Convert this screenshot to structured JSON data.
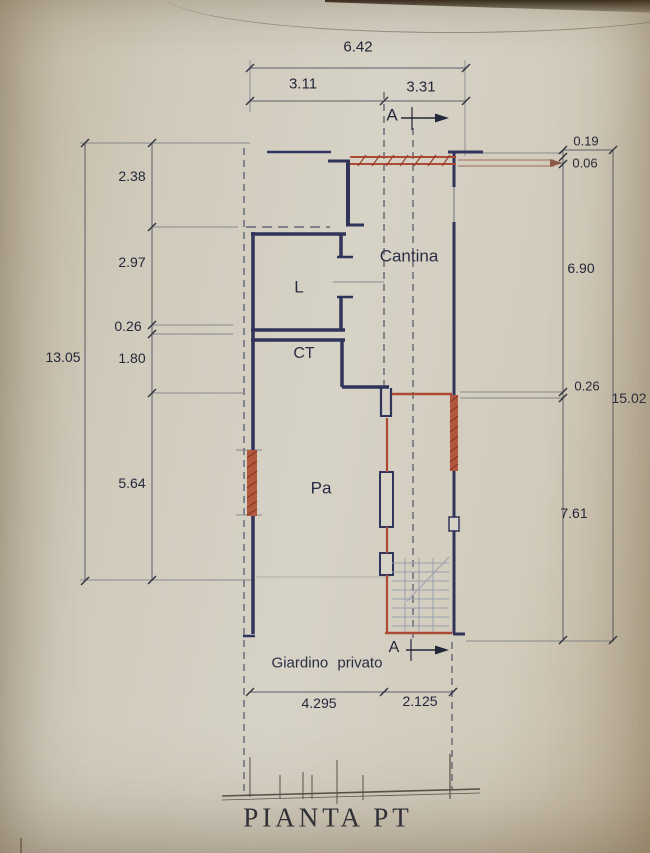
{
  "drawing": {
    "title": "PIANTA PT",
    "garden_label": "Giardino privato",
    "section_marker_top": "A",
    "section_marker_bottom": "A",
    "rooms": {
      "cantina": "Cantina",
      "l": "L",
      "ct": "CT",
      "pa": "Pa"
    },
    "dims": {
      "top_total": "6.42",
      "top_left": "3.11",
      "top_right": "3.31",
      "left_1": "2.38",
      "left_2": "2.97",
      "left_3": "0.26",
      "left_4": "1.80",
      "left_5": "5.64",
      "left_total": "13.05",
      "right_1": "0.19",
      "right_2": "0.06",
      "right_3": "6.90",
      "right_4": "0.26",
      "right_5": "7.61",
      "right_total": "15.02",
      "bottom_left": "4.295",
      "bottom_right": "2.125"
    },
    "colors": {
      "wall_ink": "#30345a",
      "masonry_red": "#ad4a35",
      "dim_line": "#5b5f6a",
      "paper": "#d3cdbf",
      "text": "#23273a"
    }
  }
}
